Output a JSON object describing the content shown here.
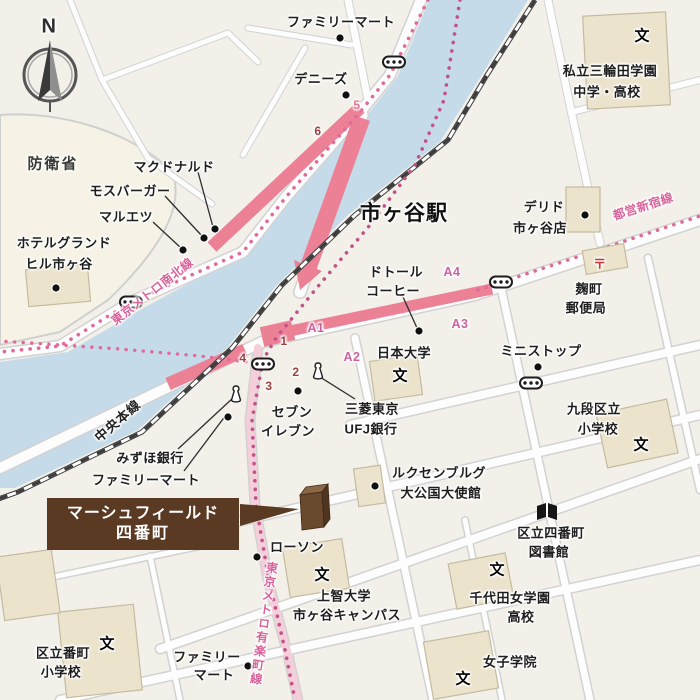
{
  "map_title": "市ヶ谷駅",
  "compass": {
    "label": "N"
  },
  "highlight_box": {
    "line1": "マーシュフィールド",
    "line2": "四番町",
    "bg": "#5a3a22"
  },
  "colors": {
    "background": "#f2f0e9",
    "river": "#c6dbe9",
    "route_pink": "#ec8196",
    "metro_dot_pink": "#e06a9a",
    "metro_dot_purple": "#c2538a",
    "building_beige": "#ebe3cc",
    "defense_area": "#f6f3e6",
    "highlight_brown": "#5a3a22",
    "exit_maroon": "#9e4040",
    "a_exit_pink": "#cb62a0"
  },
  "labels": [
    {
      "name": "compass-label",
      "text": "N",
      "x": 49,
      "y": 27,
      "c": "compassN"
    },
    {
      "name": "area-boueisho",
      "text": "防衛省",
      "x": 53,
      "y": 163,
      "c": "area"
    },
    {
      "name": "poi-familymart-north",
      "text": "ファミリーマート",
      "x": 341,
      "y": 21,
      "c": ""
    },
    {
      "name": "poi-dennys",
      "text": "デニーズ",
      "x": 321,
      "y": 78,
      "c": ""
    },
    {
      "name": "poi-mcdonalds",
      "text": "マクドナルド",
      "x": 174,
      "y": 166,
      "c": ""
    },
    {
      "name": "poi-mosburger",
      "text": "モスバーガー",
      "x": 130,
      "y": 190,
      "c": ""
    },
    {
      "name": "poi-maruetsu",
      "text": "マルエツ",
      "x": 126,
      "y": 216,
      "c": ""
    },
    {
      "name": "poi-hotel-grandhill-1",
      "text": "ホテルグランド",
      "x": 64,
      "y": 242,
      "c": ""
    },
    {
      "name": "poi-hotel-grandhill-2",
      "text": "ヒル市ヶ谷",
      "x": 59,
      "y": 263,
      "c": ""
    },
    {
      "name": "station-title",
      "text": "市ヶ谷駅",
      "x": 404,
      "y": 212,
      "c": "big"
    },
    {
      "name": "school-miwada-1",
      "text": "私立三輪田学園",
      "x": 610,
      "y": 70,
      "c": ""
    },
    {
      "name": "school-miwada-2",
      "text": "中学・高校",
      "x": 607,
      "y": 91,
      "c": ""
    },
    {
      "name": "poi-delido-1",
      "text": "デリド",
      "x": 544,
      "y": 206,
      "c": ""
    },
    {
      "name": "poi-delido-2",
      "text": "市ヶ谷店",
      "x": 540,
      "y": 227,
      "c": ""
    },
    {
      "name": "line-toei-shinjuku",
      "text": "都営新宿線",
      "x": 643,
      "y": 206,
      "c": "linep",
      "r": -18
    },
    {
      "name": "poi-kojimachi-post-1",
      "text": "麹町",
      "x": 589,
      "y": 288,
      "c": ""
    },
    {
      "name": "poi-kojimachi-post-2",
      "text": "郵便局",
      "x": 586,
      "y": 307,
      "c": ""
    },
    {
      "name": "poi-doutor-1",
      "text": "ドトール",
      "x": 396,
      "y": 271,
      "c": ""
    },
    {
      "name": "poi-doutor-2",
      "text": "コーヒー",
      "x": 393,
      "y": 290,
      "c": ""
    },
    {
      "name": "school-nihon-univ",
      "text": "日本大学",
      "x": 404,
      "y": 352,
      "c": ""
    },
    {
      "name": "poi-ministop",
      "text": "ミニストップ",
      "x": 541,
      "y": 350,
      "c": ""
    },
    {
      "name": "school-kudan-1",
      "text": "九段区立",
      "x": 594,
      "y": 408,
      "c": ""
    },
    {
      "name": "school-kudan-2",
      "text": "小学校",
      "x": 598,
      "y": 428,
      "c": ""
    },
    {
      "name": "line-tokyo-metro-namboku",
      "text": "東京メトロ南北線",
      "x": 152,
      "y": 291,
      "c": "linep",
      "r": -38
    },
    {
      "name": "line-chuo-honsen",
      "text": "中央本線",
      "x": 117,
      "y": 420,
      "c": "rail",
      "r": -41
    },
    {
      "name": "poi-mizuho-bank",
      "text": "みずほ銀行",
      "x": 150,
      "y": 457,
      "c": ""
    },
    {
      "name": "poi-familymart-mid",
      "text": "ファミリーマート",
      "x": 146,
      "y": 479,
      "c": ""
    },
    {
      "name": "poi-seven-eleven-1",
      "text": "セブン",
      "x": 292,
      "y": 411,
      "c": ""
    },
    {
      "name": "poi-seven-eleven-2",
      "text": "イレブン",
      "x": 288,
      "y": 430,
      "c": ""
    },
    {
      "name": "poi-mitsubishi-ufj-1",
      "text": "三菱東京",
      "x": 372,
      "y": 408,
      "c": ""
    },
    {
      "name": "poi-mitsubishi-ufj-2",
      "text": "UFJ銀行",
      "x": 371,
      "y": 428,
      "c": ""
    },
    {
      "name": "poi-luxembourg-1",
      "text": "ルクセンブルグ",
      "x": 439,
      "y": 472,
      "c": ""
    },
    {
      "name": "poi-luxembourg-2",
      "text": "大公国大使館",
      "x": 441,
      "y": 492,
      "c": ""
    },
    {
      "name": "poi-lawson",
      "text": "ローソン",
      "x": 297,
      "y": 546,
      "c": ""
    },
    {
      "name": "school-sophia-1",
      "text": "上智大学",
      "x": 344,
      "y": 595,
      "c": ""
    },
    {
      "name": "school-sophia-2",
      "text": "市ヶ谷キャンパス",
      "x": 347,
      "y": 614,
      "c": ""
    },
    {
      "name": "line-tokyo-metro-yurakucho",
      "text": "東京メトロ有楽町線",
      "x": 264,
      "y": 624,
      "c": "linep vert",
      "r": 8
    },
    {
      "name": "poi-library-1",
      "text": "区立四番町",
      "x": 551,
      "y": 532,
      "c": ""
    },
    {
      "name": "poi-library-2",
      "text": "図書館",
      "x": 549,
      "y": 551,
      "c": ""
    },
    {
      "name": "school-chiyoda-1",
      "text": "千代田女学園",
      "x": 510,
      "y": 597,
      "c": ""
    },
    {
      "name": "school-chiyoda-2",
      "text": "高校",
      "x": 521,
      "y": 616,
      "c": ""
    },
    {
      "name": "school-joshi-gakuin",
      "text": "女子学院",
      "x": 510,
      "y": 661,
      "c": ""
    },
    {
      "name": "school-bancho-1",
      "text": "区立番町",
      "x": 63,
      "y": 652,
      "c": ""
    },
    {
      "name": "school-bancho-2",
      "text": "小学校",
      "x": 61,
      "y": 671,
      "c": ""
    },
    {
      "name": "poi-familymart-south-1",
      "text": "ファミリー",
      "x": 207,
      "y": 656,
      "c": ""
    },
    {
      "name": "poi-familymart-south-2",
      "text": "マート",
      "x": 214,
      "y": 674,
      "c": ""
    },
    {
      "name": "school-mark-miwada",
      "text": "文",
      "x": 642,
      "y": 35,
      "c": "mark"
    },
    {
      "name": "school-mark-nihon-univ",
      "text": "文",
      "x": 400,
      "y": 375,
      "c": "mark"
    },
    {
      "name": "school-mark-kudan",
      "text": "文",
      "x": 641,
      "y": 444,
      "c": "mark"
    },
    {
      "name": "school-mark-sophia",
      "text": "文",
      "x": 322,
      "y": 574,
      "c": "mark"
    },
    {
      "name": "school-mark-chiyoda",
      "text": "文",
      "x": 497,
      "y": 569,
      "c": "mark"
    },
    {
      "name": "school-mark-joshi",
      "text": "文",
      "x": 463,
      "y": 678,
      "c": "mark"
    },
    {
      "name": "school-mark-bancho",
      "text": "文",
      "x": 107,
      "y": 643,
      "c": "mark"
    },
    {
      "name": "post-office-mark",
      "text": "〒",
      "x": 600,
      "y": 263,
      "c": "post"
    },
    {
      "name": "exit-1",
      "text": "1",
      "x": 284,
      "y": 341,
      "c": "exit"
    },
    {
      "name": "exit-2",
      "text": "2",
      "x": 296,
      "y": 372,
      "c": "exit"
    },
    {
      "name": "exit-3",
      "text": "3",
      "x": 269,
      "y": 386,
      "c": "exit"
    },
    {
      "name": "exit-4",
      "text": "4",
      "x": 243,
      "y": 358,
      "c": "exit"
    },
    {
      "name": "exit-5",
      "text": "5",
      "x": 357,
      "y": 105,
      "c": "exit5"
    },
    {
      "name": "exit-6",
      "text": "6",
      "x": 318,
      "y": 131,
      "c": "exit"
    },
    {
      "name": "exit-a1",
      "text": "A1",
      "x": 316,
      "y": 328,
      "c": "aexit"
    },
    {
      "name": "exit-a2",
      "text": "A2",
      "x": 352,
      "y": 357,
      "c": "aexit"
    },
    {
      "name": "exit-a3",
      "text": "A3",
      "x": 460,
      "y": 324,
      "c": "aexit"
    },
    {
      "name": "exit-a4",
      "text": "A4",
      "x": 452,
      "y": 272,
      "c": "aexit"
    }
  ],
  "poi_dots": [
    {
      "name": "dot-familymart-north",
      "x": 340,
      "y": 38
    },
    {
      "name": "dot-dennys",
      "x": 346,
      "y": 95
    },
    {
      "name": "dot-mcdonalds",
      "x": 215,
      "y": 229
    },
    {
      "name": "dot-mosburger",
      "x": 204,
      "y": 238
    },
    {
      "name": "dot-maruetsu",
      "x": 183,
      "y": 250
    },
    {
      "name": "dot-hotel-grandhill",
      "x": 56,
      "y": 288
    },
    {
      "name": "dot-delido",
      "x": 585,
      "y": 215
    },
    {
      "name": "dot-doutor-coffee",
      "x": 419,
      "y": 331
    },
    {
      "name": "dot-seven-eleven",
      "x": 298,
      "y": 391
    },
    {
      "name": "dot-familymart-mid",
      "x": 228,
      "y": 417
    },
    {
      "name": "dot-ministop",
      "x": 538,
      "y": 367
    },
    {
      "name": "dot-luxembourg",
      "x": 375,
      "y": 486
    },
    {
      "name": "dot-lawson",
      "x": 257,
      "y": 557
    },
    {
      "name": "dot-familymart-south",
      "x": 248,
      "y": 666
    }
  ],
  "bank_icons": [
    {
      "name": "bank-icon-mitsubishi-ufj",
      "x": 318,
      "y": 371
    },
    {
      "name": "bank-icon-mizuho",
      "x": 236,
      "y": 394
    }
  ],
  "station_markers": [
    {
      "name": "subway-marker-namboku-north",
      "x": 394,
      "y": 62
    },
    {
      "name": "subway-marker-namboku-west",
      "x": 131,
      "y": 302
    },
    {
      "name": "subway-marker-yurakucho",
      "x": 263,
      "y": 364
    },
    {
      "name": "subway-marker-shinjuku-line",
      "x": 501,
      "y": 282
    },
    {
      "name": "subway-marker-hanzomon",
      "x": 531,
      "y": 383
    }
  ],
  "leader_lines": [
    {
      "name": "leader-mcdonalds",
      "x1": 198,
      "y1": 172,
      "x2": 213,
      "y2": 227
    },
    {
      "name": "leader-mosburger",
      "x1": 165,
      "y1": 196,
      "x2": 202,
      "y2": 236
    },
    {
      "name": "leader-maruetsu",
      "x1": 153,
      "y1": 222,
      "x2": 181,
      "y2": 248
    },
    {
      "name": "leader-doutor",
      "x1": 403,
      "y1": 297,
      "x2": 417,
      "y2": 328
    },
    {
      "name": "leader-mizuho",
      "x1": 178,
      "y1": 449,
      "x2": 234,
      "y2": 397
    },
    {
      "name": "leader-familymart-mid",
      "x1": 184,
      "y1": 471,
      "x2": 226,
      "y2": 415
    },
    {
      "name": "leader-mitsubishi-ufj",
      "x1": 355,
      "y1": 399,
      "x2": 320,
      "y2": 377
    }
  ]
}
